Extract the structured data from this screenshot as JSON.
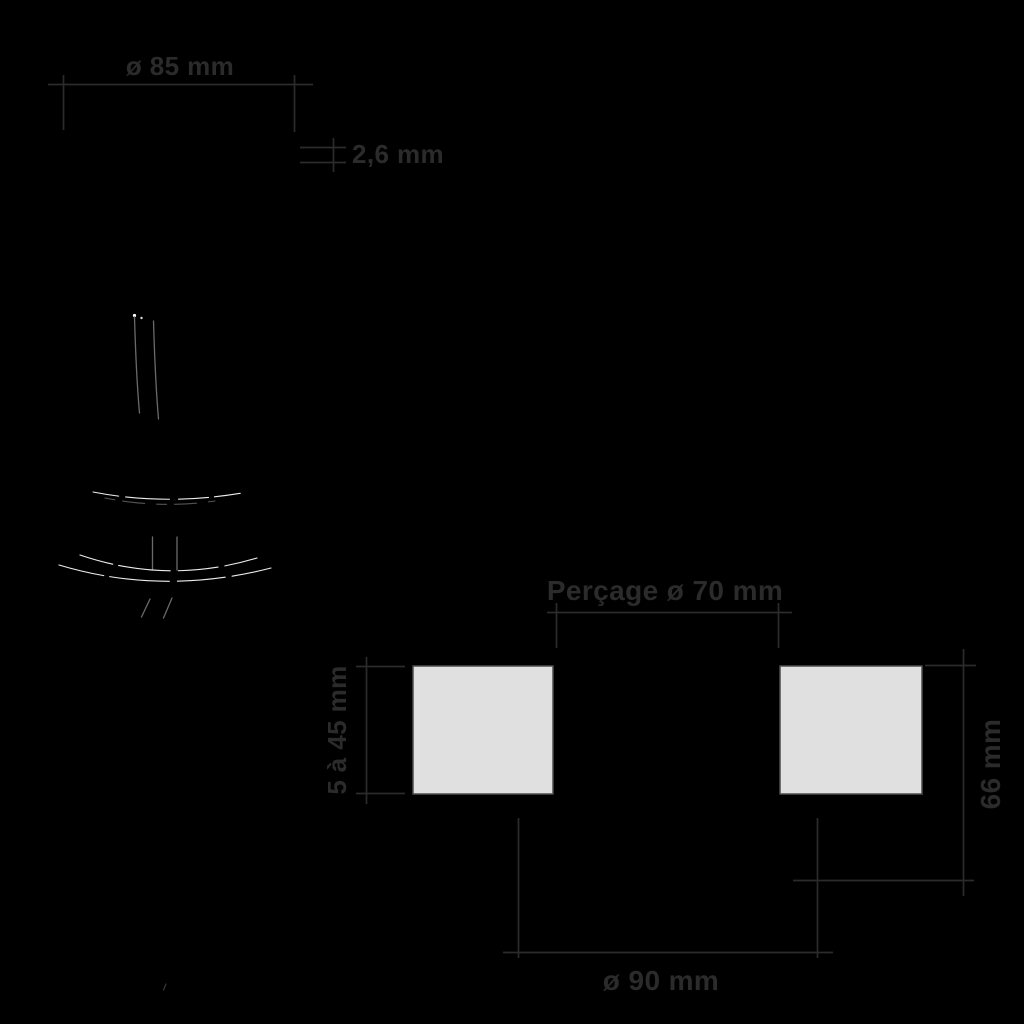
{
  "theme": {
    "background": "#000000",
    "annotation_color": "#2b2b2b",
    "square_fill": "#e0e0e0",
    "square_border": "#4d4d4d",
    "sketch_cable": "#6a6a6a",
    "sketch_highlight": "#eeeeee"
  },
  "side_view": {
    "diameter_label": "ø 85 mm",
    "thickness_label": "2,6 mm"
  },
  "installation_view": {
    "drill_label": "Perçage ø 70 mm",
    "ceiling_range_label": "5 à 45 mm",
    "depth_label": "66 mm",
    "outer_diameter_label": "ø 90 mm"
  }
}
